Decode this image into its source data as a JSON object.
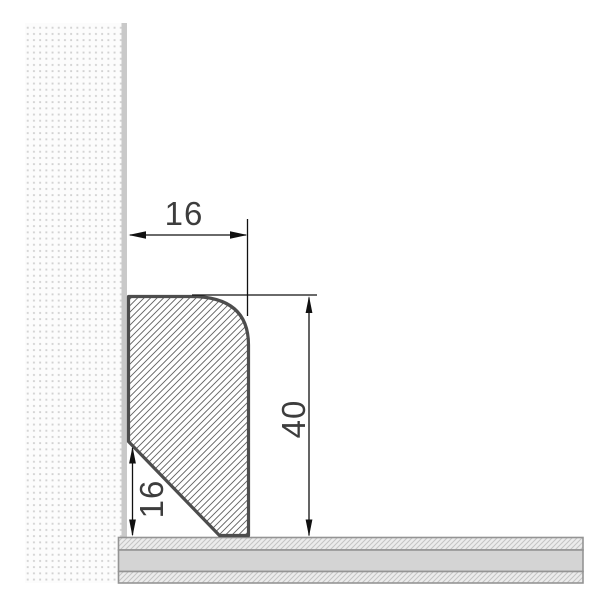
{
  "diagram": {
    "type": "skirting-board-cross-section",
    "dimensions": {
      "profile_width": "16",
      "profile_height": "40",
      "bottom_bevel_height": "16"
    },
    "colors": {
      "profile_outline": "#4d4d4d",
      "profile_hatch_line": "#5f5f5f",
      "dimension_line": "#111111",
      "label_text": "#3d3d3d",
      "wall_dot": "#d2d2d2",
      "wall_surface_bar": "#c9c9c9",
      "floor_core_band": "#d4d4d4",
      "floor_hatch_bg": "#ececec",
      "floor_hatch_line": "#c4c4c4",
      "floor_border": "#949494"
    }
  }
}
